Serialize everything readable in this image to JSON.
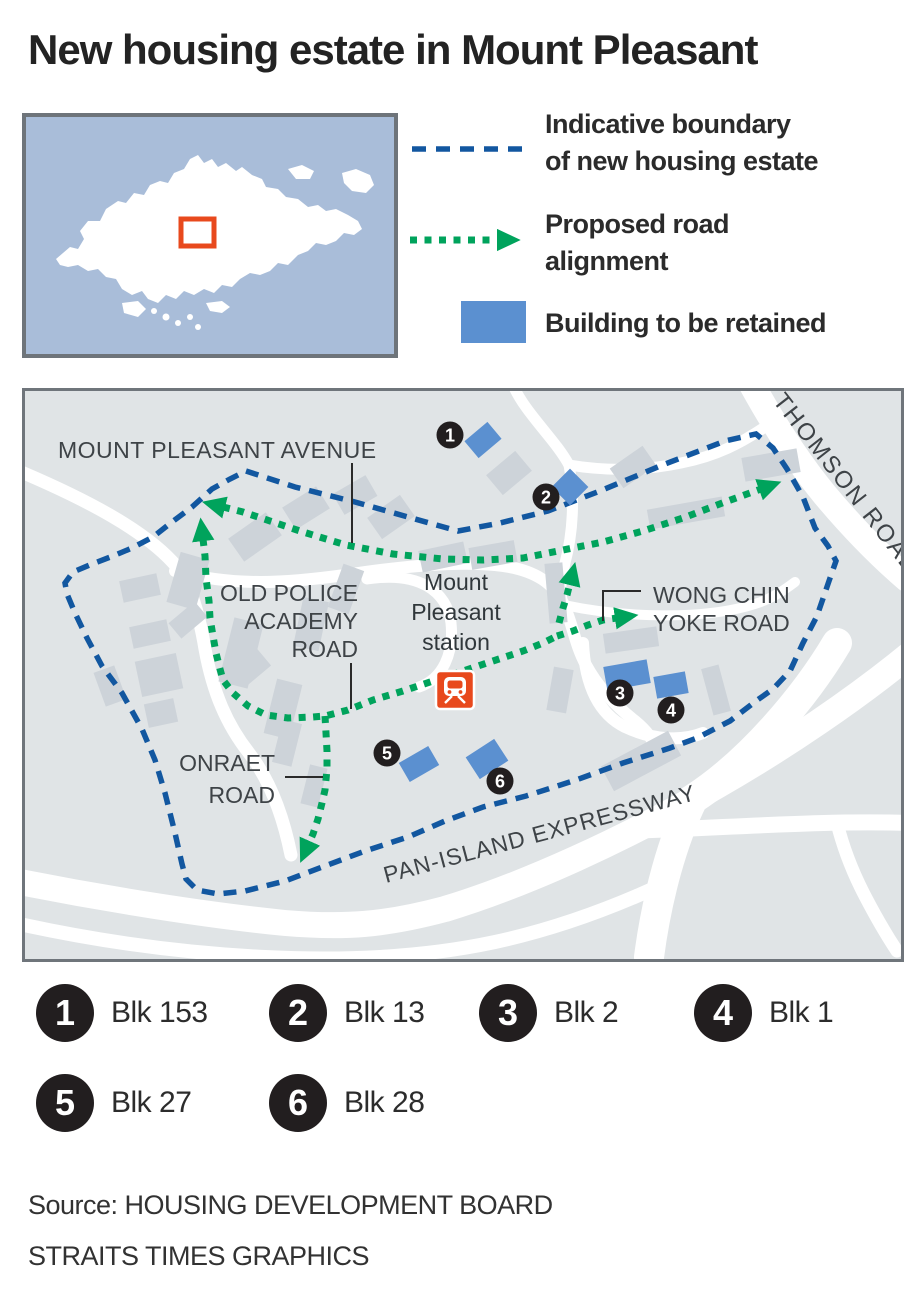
{
  "title": "New housing estate in Mount Pleasant",
  "inset": {
    "description": "singapore-locator-map"
  },
  "legend": {
    "boundary": {
      "line1": "Indicative boundary",
      "line2": "of new housing estate"
    },
    "road": {
      "line1": "Proposed road",
      "line2": "alignment"
    },
    "building": {
      "label": "Building to be retained"
    }
  },
  "map": {
    "labels": {
      "mount_pleasant_avenue": "MOUNT PLEASANT AVENUE",
      "old_police_academy_road": [
        "OLD POLICE",
        "ACADEMY",
        "ROAD"
      ],
      "onraet_road": [
        "ONRAET",
        "ROAD"
      ],
      "wong_chin_yoke_road": [
        "WONG CHIN",
        "YOKE ROAD"
      ],
      "thomson_road": "THOMSON ROAD",
      "pan_island_expressway": "PAN-ISLAND EXPRESSWAY",
      "station": [
        "Mount",
        "Pleasant",
        "station"
      ]
    },
    "markers": [
      "1",
      "2",
      "3",
      "4",
      "5",
      "6"
    ]
  },
  "blocks": [
    {
      "num": "1",
      "label": "Blk 153"
    },
    {
      "num": "2",
      "label": "Blk 13"
    },
    {
      "num": "3",
      "label": "Blk 2"
    },
    {
      "num": "4",
      "label": "Blk 1"
    },
    {
      "num": "5",
      "label": "Blk 27"
    },
    {
      "num": "6",
      "label": "Blk 28"
    }
  ],
  "source": {
    "line1": "Source: HOUSING DEVELOPMENT BOARD",
    "line2": "STRAITS TIMES GRAPHICS"
  },
  "colors": {
    "boundary_blue": "#1257a0",
    "road_green": "#00a35c",
    "building_blue": "#5b90d0",
    "building_gray": "#cdd3d9",
    "map_bg": "#e0e4e6",
    "badge_black": "#221e1f",
    "mrt_orange": "#e8491d",
    "inset_sea": "#a9bdd9",
    "locator_red": "#e8491d"
  }
}
